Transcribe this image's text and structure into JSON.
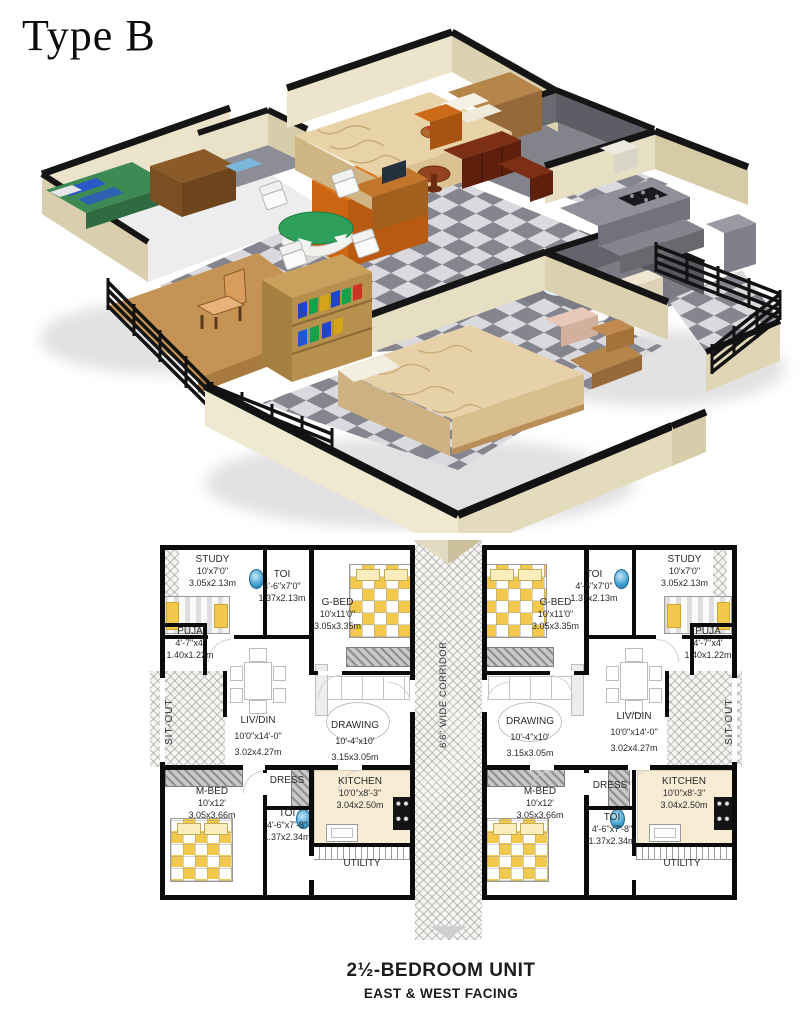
{
  "title": "Type B",
  "corridor_label": "6'6\" WIDE CORRIDOR",
  "footer": {
    "line1": "2½-BEDROOM UNIT",
    "line2": "EAST & WEST FACING"
  },
  "units": {
    "left": {
      "rooms": {
        "study": {
          "name": "STUDY",
          "ft": "10'x7'0\"",
          "m": "3.05x2.13m"
        },
        "toi_top": {
          "name": "TOI",
          "ft": "4'-6\"x7'0\"",
          "m": "1.37x2.13m"
        },
        "g_bed": {
          "name": "G-BED",
          "ft": "10'x11'0\"",
          "m": "3.05x3.35m"
        },
        "puja": {
          "name": "PUJA",
          "ft": "4'-7\"x4'",
          "m": "1.40x1.22m"
        },
        "sit_out": {
          "name": "SIT-OUT"
        },
        "liv_din": {
          "name": "LIV/DIN",
          "ft": "10'0\"x14'-0\"",
          "m": "3.02x4.27m"
        },
        "drawing": {
          "name": "DRAWING",
          "ft": "10'-4\"x10'",
          "m": "3.15x3.05m"
        },
        "m_bed": {
          "name": "M-BED",
          "ft": "10'x12'",
          "m": "3.05x3.66m"
        },
        "dress": {
          "name": "DRESS"
        },
        "toi_bottom": {
          "name": "TOI",
          "ft": "4'-6\"x7'-8\"",
          "m": "1.37x2.34m"
        },
        "kitchen": {
          "name": "KITCHEN",
          "ft": "10'0\"x8'-3\"",
          "m": "3.04x2.50m"
        },
        "utility": {
          "name": "UTILITY"
        }
      }
    },
    "right": {
      "rooms": {
        "study": {
          "name": "STUDY",
          "ft": "10'x7'0\"",
          "m": "3.05x2.13m"
        },
        "toi_top": {
          "name": "TOI",
          "ft": "4'-6\"x7'0\"",
          "m": "1.37x2.13m"
        },
        "g_bed": {
          "name": "G-BED",
          "ft": "10'x11'0\"",
          "m": "3.05x3.35m"
        },
        "puja": {
          "name": "PUJA",
          "ft": "4'-7\"x4'",
          "m": "1.40x1.22m"
        },
        "sit_out": {
          "name": "SIT-OUT"
        },
        "liv_din": {
          "name": "LIV/DIN",
          "ft": "10'0\"x14'-0\"",
          "m": "3.02x4.27m"
        },
        "drawing": {
          "name": "DRAWING",
          "ft": "10'-4\"x10'",
          "m": "3.15x3.05m"
        },
        "m_bed": {
          "name": "M-BED",
          "ft": "10'x12'",
          "m": "3.05x3.66m"
        },
        "dress": {
          "name": "DRESS"
        },
        "toi_bottom": {
          "name": "TOI",
          "ft": "4'-6\"x7'-8\"",
          "m": "1.37x2.34m"
        },
        "kitchen": {
          "name": "KITCHEN",
          "ft": "10'0\"x8'-3\"",
          "m": "3.04x2.50m"
        },
        "utility": {
          "name": "UTILITY"
        }
      }
    }
  },
  "palette": {
    "wall_cream": "#ebe4ca",
    "wall_cap": "#141414",
    "floor_dark": "#85858f",
    "floor_light": "#d9d9de",
    "deck_wood": "#c59455",
    "bed_tan": "#e7d1a8",
    "accent_orange": "#d96f1e",
    "table_green": "#2fa05c",
    "sofa_brown": "#6e2812",
    "fixture_blue": "#3f9fd0",
    "plan_yellow": "#f2c94c",
    "hatch_gray": "#919191"
  }
}
